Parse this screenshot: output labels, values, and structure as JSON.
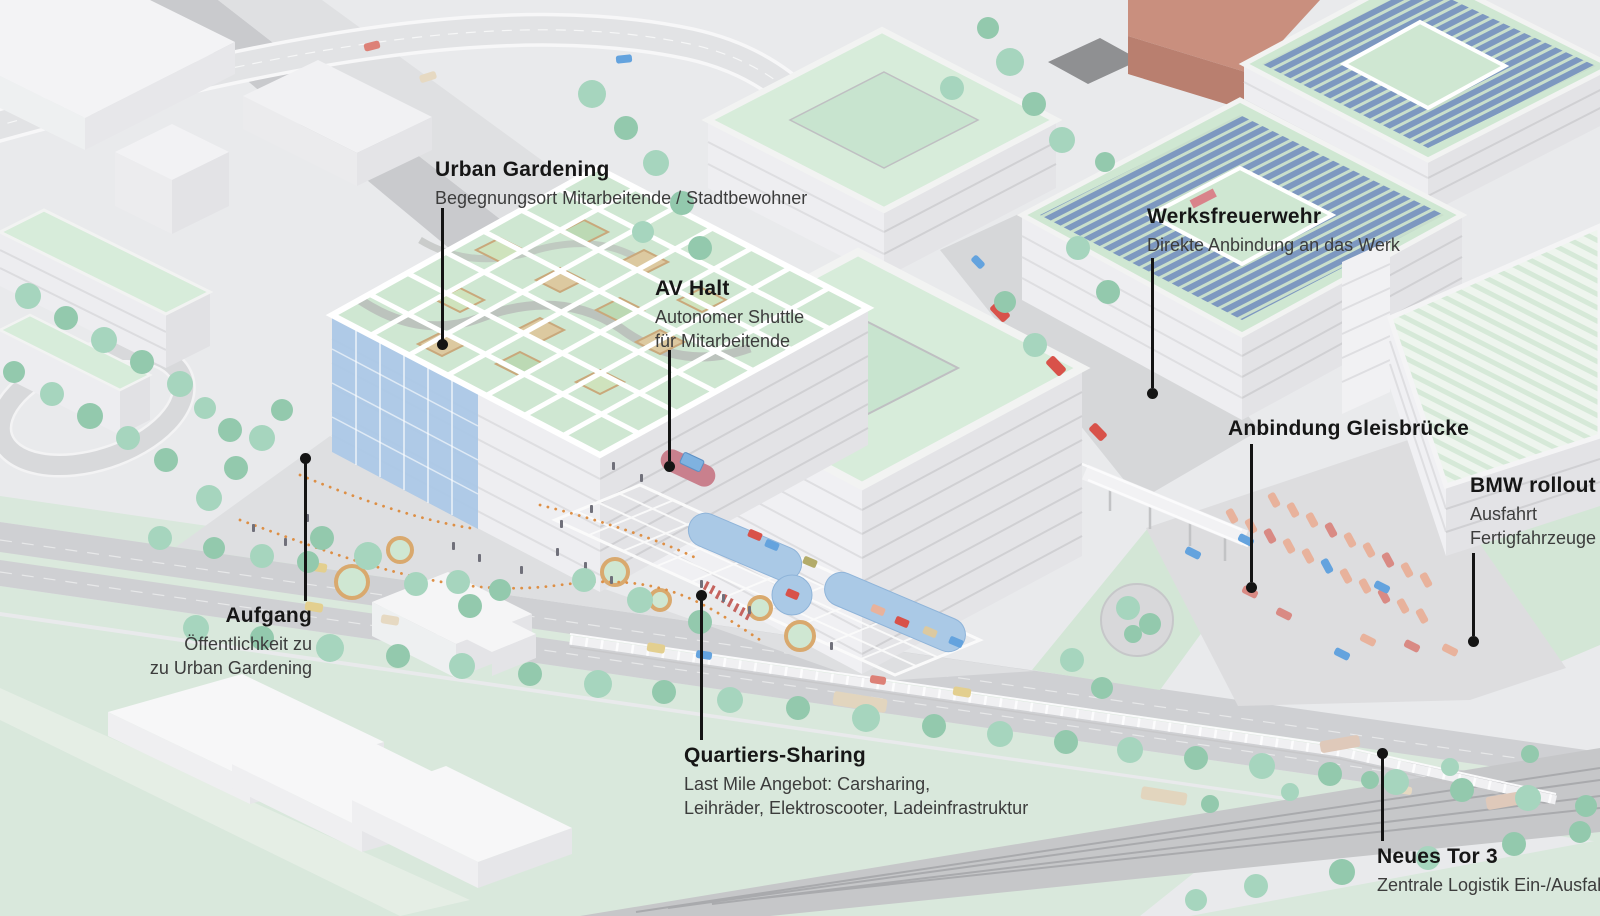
{
  "scene": {
    "type": "axonometric-site-plan-illustration",
    "language": "de",
    "palette": {
      "ground": "#e9eaec",
      "road": "#cfd0d3",
      "lawn": "#d9e8dc",
      "roof_green": "#d5ebd8",
      "wall_light": "#f1f1f3",
      "wall_shade": "#e3e3e6",
      "glass_blue": "#a9c7e6",
      "solar_panel_blue": "#7d98c0",
      "brick": "#c98f7e",
      "tree_green": "#a6d5be",
      "fire_truck_red": "#d8524a",
      "shuttle_stop_red": "#c9808d",
      "car_salmon": "#e8b29c",
      "path_dot_orange": "#dd8f45",
      "label_text": "#1a1a1a",
      "leader_black": "#141414"
    },
    "features": [
      {
        "name": "urban-gardening-building",
        "description": "structure with rooftop garden grid and blue glass facade"
      },
      {
        "name": "office-building-front",
        "description": "white courtyard building with green roof"
      },
      {
        "name": "office-building-back",
        "description": "white courtyard building with green roof"
      },
      {
        "name": "solar-roof-building-west",
        "description": "building with photovoltaic roof and courtyard"
      },
      {
        "name": "solar-roof-building-east",
        "description": "building with photovoltaic roof"
      },
      {
        "name": "brick-building",
        "description": "terracotta building"
      },
      {
        "name": "factory-hall",
        "description": "large hall with striped light green roof"
      },
      {
        "name": "rollout-parking",
        "description": "rows of finished vehicles on plaza"
      },
      {
        "name": "boulevard",
        "description": "tree-lined street with vehicles"
      },
      {
        "name": "railway",
        "description": "rail tracks with freight trucks and truss bridge"
      },
      {
        "name": "sharing-plaza",
        "description": "mobility hub with pergola, sharing pads and shuttle stop"
      }
    ]
  },
  "labels": [
    {
      "id": "urban-gardening",
      "title": "Urban Gardening",
      "lines": [
        "Begegnungsort Mitarbeitende / Stadtbewohner"
      ]
    },
    {
      "id": "av-halt",
      "title": "AV Halt",
      "lines": [
        "Autonomer Shuttle",
        "für Mitarbeitende"
      ]
    },
    {
      "id": "werksfeuerwehr",
      "title": "Werksfreuerwehr",
      "lines": [
        "Direkte Anbindung an das Werk"
      ]
    },
    {
      "id": "anbindung-gleisbruecke",
      "title": "Anbindung Gleisbrücke",
      "lines": []
    },
    {
      "id": "bmw-rollout",
      "title": "BMW rollout",
      "lines": [
        "Ausfahrt",
        "Fertigfahrzeuge"
      ]
    },
    {
      "id": "aufgang",
      "title": "Aufgang",
      "lines": [
        "Öffentlichkeit zu",
        "zu Urban Gardening"
      ]
    },
    {
      "id": "quartiers-sharing",
      "title": "Quartiers-Sharing",
      "lines": [
        "Last Mile Angebot: Carsharing,",
        "Leihräder, Elektroscooter, Ladeinfrastruktur"
      ]
    },
    {
      "id": "neues-tor-3",
      "title": "Neues Tor 3",
      "lines": [
        "Zentrale Logistik Ein-/Ausfahrt"
      ]
    }
  ]
}
